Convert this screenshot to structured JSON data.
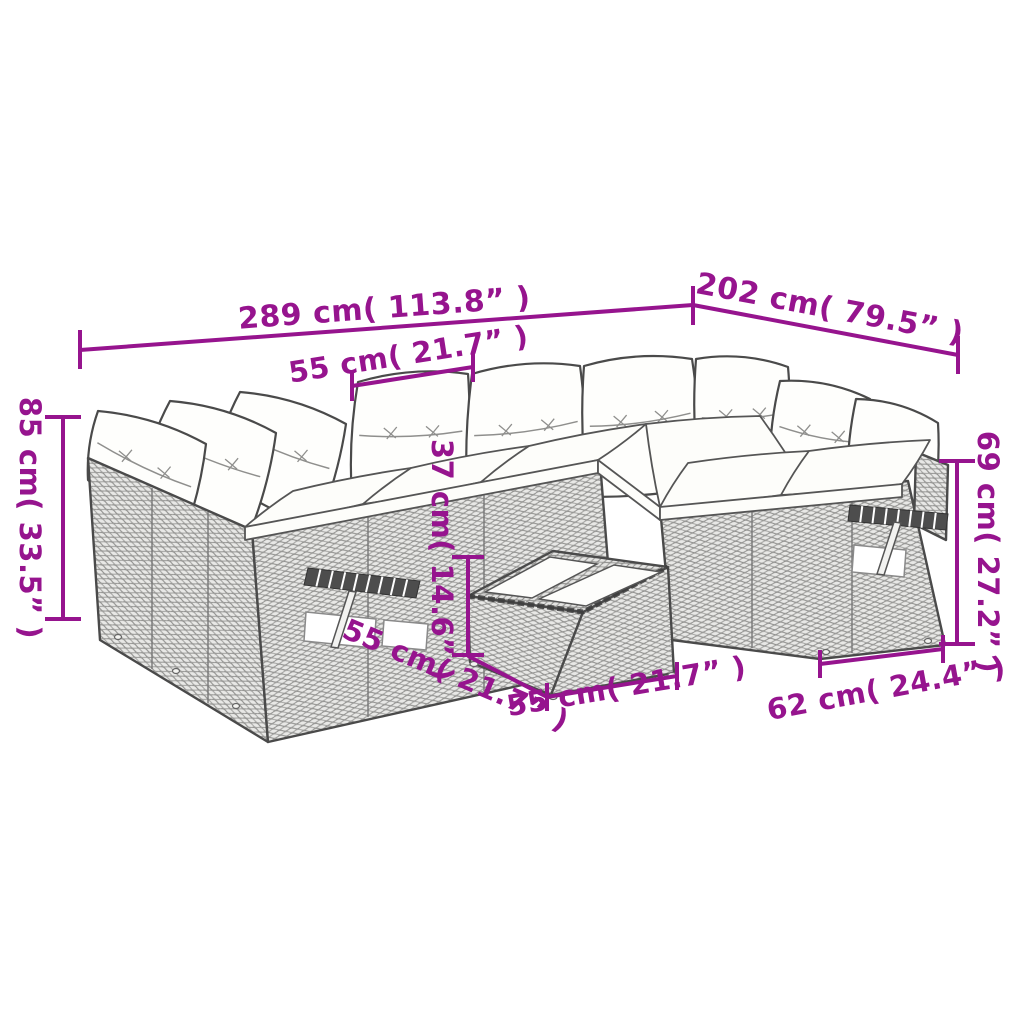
{
  "colors": {
    "dimension": "#96148E",
    "line_art": "#4a4a4a"
  },
  "dimensions": {
    "overall_width": "289 cm( 113.8” )",
    "overall_depth": "202 cm( 79.5” )",
    "seat_width": "55 cm( 21.7” )",
    "total_height": "85 cm( 33.5” )",
    "backrest_height": "69 cm( 27.2” )",
    "table_height": "37 cm( 14.6” )",
    "seat_depth": "55 cm( 21.7” )",
    "table_width": "55 cm( 21.7” )",
    "end_seat_width": "62 cm( 24.4” )"
  }
}
